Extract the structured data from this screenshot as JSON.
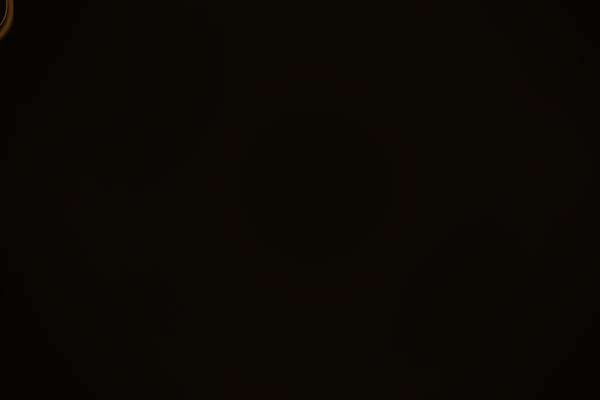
{
  "scene": {
    "label": "Aerial night-time architectural rendering of a city square: an oval park dense with illuminated trees, ringed by bright lit roads and pavements with pedestrians and cars, dark historic buildings to the left and pale massing-model buildings to the right",
    "palette": {
      "night_base": "#0b0703",
      "pavement_bright": "#f6eedb",
      "pavement_mid": "#e6dac2",
      "pavement_edge": "#b3a488",
      "road": "#d8cdbb",
      "road_dim": "#b9ae9c",
      "road_glow": "#fffbec",
      "park_dark": "#26301a",
      "park_light": "#879245",
      "park_highlight": "#d6cf6f",
      "building_dark": "#2b241c",
      "building_beige": "#b2a18b",
      "building_face_light": "#ddd6c9",
      "roof_gray": "#7c7366",
      "people_dark": "#17141b",
      "lamp_light": "#fff6d8",
      "lit_window": "#d9a852",
      "flare_orange": "#c97a2c"
    },
    "pavement": [
      {
        "x": 150,
        "y": 40,
        "w": 340,
        "h": 280,
        "rx": 80,
        "rot": -8
      },
      {
        "x": 205,
        "y": -10,
        "w": 190,
        "h": 92,
        "rx": 18,
        "rot": -4
      },
      {
        "x": 455,
        "y": 35,
        "w": 150,
        "h": 72,
        "rx": 10,
        "rot": -12
      },
      {
        "x": 165,
        "y": 255,
        "w": 150,
        "h": 150,
        "rx": 20,
        "rot": -15
      },
      {
        "x": 370,
        "y": 280,
        "w": 200,
        "h": 112,
        "rx": 24,
        "rot": -12
      },
      {
        "x": 334,
        "y": -8,
        "w": 54,
        "h": 80,
        "rx": 6,
        "rot": 3
      },
      {
        "x": 115,
        "y": 85,
        "w": 120,
        "h": 180,
        "rx": 30,
        "rot": -15
      }
    ],
    "stipple": {
      "count": 150,
      "color": "#a2937b"
    },
    "ring_road": {
      "cx": 320,
      "cy": 180,
      "rx": 148,
      "ry": 122,
      "rot": -8,
      "width": 19
    },
    "inner_glow_ring": {
      "cx": 320,
      "cy": 180,
      "rx": 126,
      "ry": 101,
      "rot": -8,
      "width": 16
    },
    "streets": [
      {
        "d": "M 362,-10 L 368,62",
        "w": 21,
        "dim": true
      },
      {
        "d": "M 176,216 Q 228,272 258,318 Q 280,356 288,410",
        "w": 25,
        "dim": false
      },
      {
        "d": "M 396,306 L 608,374",
        "w": 25,
        "dim": false
      },
      {
        "d": "M 455,97 L 612,58",
        "w": 17,
        "dim": true
      }
    ],
    "light_pools": [
      {
        "x": 250,
        "y": 62,
        "r": 55
      },
      {
        "x": 350,
        "y": 72,
        "r": 48
      },
      {
        "x": 428,
        "y": 96,
        "r": 42
      },
      {
        "x": 198,
        "y": 150,
        "r": 50
      },
      {
        "x": 183,
        "y": 232,
        "r": 46
      },
      {
        "x": 246,
        "y": 302,
        "r": 55
      },
      {
        "x": 320,
        "y": 298,
        "r": 48
      },
      {
        "x": 408,
        "y": 318,
        "r": 52
      },
      {
        "x": 466,
        "y": 178,
        "r": 42
      },
      {
        "x": 460,
        "y": 120,
        "r": 38
      },
      {
        "x": 292,
        "y": 32,
        "r": 52
      },
      {
        "x": 226,
        "y": 94,
        "r": 42
      },
      {
        "x": 508,
        "y": 330,
        "r": 38
      },
      {
        "x": 292,
        "y": 362,
        "r": 45
      },
      {
        "x": 552,
        "y": 84,
        "r": 38
      },
      {
        "x": 380,
        "y": 40,
        "r": 40
      }
    ],
    "park": {
      "cx": 320,
      "cy": 176,
      "rx": 112,
      "ry": 90,
      "rot": -6,
      "blob_count": 85,
      "greens": [
        "#26301a",
        "#31401e",
        "#3d4d24",
        "#4a5c2a",
        "#5b6c31",
        "#6e7e3a",
        "#879245"
      ],
      "highlight": {
        "cx": 348,
        "cy": 128,
        "rx": 88,
        "ry": 66
      },
      "hotspot": {
        "cx": 365,
        "cy": 115,
        "r": 40
      },
      "branch_center": {
        "x": 338,
        "y": 175
      },
      "branch_angles": [
        -80,
        -30,
        10,
        60,
        120,
        170,
        220
      ],
      "branch_color": "#8a7a4a",
      "entrance": {
        "x": 303,
        "y": 256,
        "w": 16,
        "h": 14
      }
    },
    "buildings_dark": [
      {
        "x": 34,
        "y": -22,
        "w": 210,
        "h": 92,
        "f": "#2b241c"
      },
      {
        "x": 20,
        "y": 26,
        "w": 200,
        "h": 86,
        "f": "#231c15"
      },
      {
        "x": 128,
        "y": 50,
        "w": 136,
        "h": 100,
        "f": "#372d22"
      },
      {
        "x": -16,
        "y": 58,
        "w": 140,
        "h": 124,
        "f": "#281f17"
      },
      {
        "x": 42,
        "y": 104,
        "w": 62,
        "h": 52,
        "f": "#564b40"
      },
      {
        "x": -14,
        "y": 148,
        "w": 146,
        "h": 146,
        "f": "#2d2218"
      },
      {
        "x": 58,
        "y": 182,
        "w": 126,
        "h": 112,
        "f": "#382c1f"
      },
      {
        "x": -18,
        "y": 266,
        "w": 178,
        "h": 150,
        "f": "#291e14"
      },
      {
        "x": 118,
        "y": 292,
        "w": 116,
        "h": 118,
        "f": "#231a11"
      },
      {
        "x": 322,
        "y": -14,
        "w": 34,
        "h": 78,
        "rot": 3,
        "f": "#a79e91"
      }
    ],
    "grid_patches": [
      {
        "x": 58,
        "y": 48,
        "w": 118,
        "h": 64,
        "rot": -25,
        "cols": 9,
        "rows": 4,
        "bg": "#2c251d",
        "cell": "#120d08"
      },
      {
        "x": 6,
        "y": 192,
        "w": 108,
        "h": 98,
        "rot": -25,
        "cols": 8,
        "rows": 6,
        "bg": "#342a20",
        "cell": "#16100a"
      }
    ],
    "window_strips": [
      {
        "x1": 150,
        "y1": 62,
        "x2": 236,
        "y2": 146,
        "n": 13,
        "lit": 0.45
      },
      {
        "x1": 122,
        "y1": 84,
        "x2": 206,
        "y2": 166,
        "n": 11,
        "lit": 0.2
      },
      {
        "x1": 96,
        "y1": 104,
        "x2": 180,
        "y2": 186,
        "n": 10,
        "lit": 0.12
      },
      {
        "x1": 208,
        "y1": 26,
        "x2": 256,
        "y2": 70,
        "n": 7,
        "lit": 0.5
      },
      {
        "x1": 30,
        "y1": 250,
        "x2": 90,
        "y2": 310,
        "n": 7,
        "lit": 0.08
      }
    ],
    "orange_window": {
      "x": 10,
      "y": 338
    },
    "buildings_light": [
      {
        "x": 380,
        "y": -20,
        "w": 228,
        "h": 102,
        "rot": -7,
        "f": "grad:topFace"
      },
      {
        "x": 500,
        "y": 56,
        "w": 138,
        "h": 122,
        "f": "#b2a18b"
      },
      {
        "x": 540,
        "y": 74,
        "w": 84,
        "h": 64,
        "f": "#171009"
      },
      {
        "x": 566,
        "y": 106,
        "w": 58,
        "h": 38,
        "f": "#a29177"
      },
      {
        "x": 514,
        "y": 170,
        "w": 144,
        "h": 138,
        "f": "#a08f77"
      },
      {
        "x": 558,
        "y": 194,
        "w": 88,
        "h": 72,
        "f": "#150f08"
      },
      {
        "x": 586,
        "y": 224,
        "w": 58,
        "h": 46,
        "f": "#93826a"
      },
      {
        "x": 592,
        "y": 96,
        "w": 72,
        "h": 134,
        "f": "#817460"
      },
      {
        "x": 425,
        "y": 288,
        "w": 190,
        "h": 118,
        "rot": 0,
        "f": "#1c140c"
      },
      {
        "x": 442,
        "y": 293,
        "w": 26,
        "h": 122,
        "rot": 30,
        "f": "#6f675c"
      },
      {
        "x": 484,
        "y": 305,
        "w": 26,
        "h": 122,
        "rot": 30,
        "f": "#6a6257"
      },
      {
        "x": 526,
        "y": 317,
        "w": 26,
        "h": 122,
        "rot": 30,
        "f": "#655d52"
      },
      {
        "x": 568,
        "y": 329,
        "w": 26,
        "h": 122,
        "rot": 30,
        "f": "#5f574c"
      },
      {
        "x": 320,
        "y": 326,
        "w": 188,
        "h": 112,
        "rot": -26,
        "f": "#7c7366"
      },
      {
        "x": 452,
        "y": 348,
        "w": 134,
        "h": 92,
        "rot": -26,
        "f": "#6c6356"
      }
    ],
    "roof_highlight": {
      "cx": 378,
      "cy": 388,
      "r": 48
    },
    "edge_highlights": [
      {
        "x1": 386,
        "y1": 70,
        "x2": 600,
        "y2": 96,
        "w": 2.2,
        "c": "#f4e8ce",
        "o": 0.85
      },
      {
        "x1": 505,
        "y1": 62,
        "x2": 517,
        "y2": 172,
        "w": 2.5,
        "c": "#ead9b8",
        "o": 0.8
      },
      {
        "x1": 519,
        "y1": 176,
        "x2": 531,
        "y2": 300,
        "w": 2.5,
        "c": "#e2d0ae",
        "o": 0.75
      },
      {
        "x1": 352,
        "y1": -8,
        "x2": 356,
        "y2": 58,
        "w": 1.6,
        "c": "#d9d1c3",
        "o": 0.7
      },
      {
        "x1": 326,
        "y1": 382,
        "x2": 500,
        "y2": 330,
        "w": 1.8,
        "c": "#9a917f",
        "o": 0.5
      }
    ],
    "bollard_circle": {
      "cx": 245,
      "cy": 85,
      "r": 12,
      "n": 12,
      "c": "#35302a"
    },
    "crosswalk": {
      "x": 398,
      "y": 307,
      "n": 5,
      "c": "#efe7d4"
    },
    "people_clusters": [
      {
        "cx": 282,
        "cy": 52,
        "w": 120,
        "h": 60,
        "n": 40
      },
      {
        "cx": 228,
        "cy": 118,
        "w": 44,
        "h": 75,
        "n": 16
      },
      {
        "cx": 205,
        "cy": 205,
        "w": 40,
        "h": 85,
        "n": 18
      },
      {
        "cx": 250,
        "cy": 345,
        "w": 85,
        "h": 95,
        "n": 26
      },
      {
        "cx": 430,
        "cy": 330,
        "w": 100,
        "h": 75,
        "n": 30
      },
      {
        "cx": 330,
        "cy": 270,
        "w": 170,
        "h": 36,
        "n": 20
      },
      {
        "cx": 492,
        "cy": 150,
        "w": 28,
        "h": 115,
        "n": 16
      },
      {
        "cx": 520,
        "cy": 78,
        "w": 80,
        "h": 42,
        "n": 16
      },
      {
        "cx": 566,
        "cy": 92,
        "w": 64,
        "h": 40,
        "n": 10
      },
      {
        "cx": 348,
        "cy": 30,
        "w": 60,
        "h": 50,
        "n": 10
      },
      {
        "cx": 300,
        "cy": 95,
        "w": 70,
        "h": 30,
        "n": 8
      },
      {
        "cx": 180,
        "cy": 160,
        "w": 30,
        "h": 50,
        "n": 8
      },
      {
        "cx": 455,
        "cy": 225,
        "w": 30,
        "h": 60,
        "n": 8
      },
      {
        "cx": 300,
        "cy": 385,
        "w": 60,
        "h": 30,
        "n": 8
      },
      {
        "cx": 590,
        "cy": 130,
        "w": 30,
        "h": 40,
        "n": 6
      }
    ],
    "cars": [
      {
        "x": 366,
        "y": 50,
        "r": 94,
        "c": "#eae7df"
      },
      {
        "x": 400,
        "y": 82,
        "r": 112,
        "c": "#7c3b27"
      },
      {
        "x": 430,
        "y": 97,
        "r": 120,
        "c": "#16130e"
      },
      {
        "x": 452,
        "y": 126,
        "r": 135,
        "c": "#a3b4c2"
      },
      {
        "x": 468,
        "y": 163,
        "r": 82,
        "c": "#1a150f"
      },
      {
        "x": 205,
        "y": 107,
        "r": -57,
        "c": "#e7e3d6"
      },
      {
        "x": 214,
        "y": 254,
        "r": -52,
        "c": "#6e4b31"
      },
      {
        "x": 262,
        "y": 300,
        "r": -60,
        "c": "#15120d"
      },
      {
        "x": 277,
        "y": 311,
        "r": -56,
        "c": "#1d1913"
      },
      {
        "x": 362,
        "y": 305,
        "r": 10,
        "c": "#201b14"
      },
      {
        "x": 455,
        "y": 311,
        "r": 14,
        "c": "#262019"
      },
      {
        "x": 500,
        "y": 317,
        "r": 16,
        "c": "#0f0e0c"
      },
      {
        "x": 542,
        "y": 325,
        "r": 16,
        "c": "#7e2f20"
      },
      {
        "x": 478,
        "y": 90,
        "r": -12,
        "c": "#14110d"
      }
    ],
    "lamps": [
      {
        "x1": 488,
        "y1": 6,
        "x2": 490,
        "y2": 64,
        "lx": 490,
        "ly": 62
      },
      {
        "x1": 467,
        "y1": 58,
        "x2": 467,
        "y2": 96,
        "lx": 467,
        "ly": 94
      },
      {
        "x1": 469,
        "y1": 178,
        "x2": 469,
        "y2": 208,
        "lx": 469,
        "ly": 206
      },
      {
        "x1": 258,
        "y1": 310,
        "x2": 258,
        "y2": 337,
        "lx": 258,
        "ly": 335
      },
      {
        "x1": 182,
        "y1": 0,
        "x2": 182,
        "y2": 21,
        "lx": 182,
        "ly": 20
      },
      {
        "x1": 278,
        "y1": 32,
        "x2": 278,
        "y2": 86,
        "lx": 278,
        "ly": 34
      }
    ]
  }
}
